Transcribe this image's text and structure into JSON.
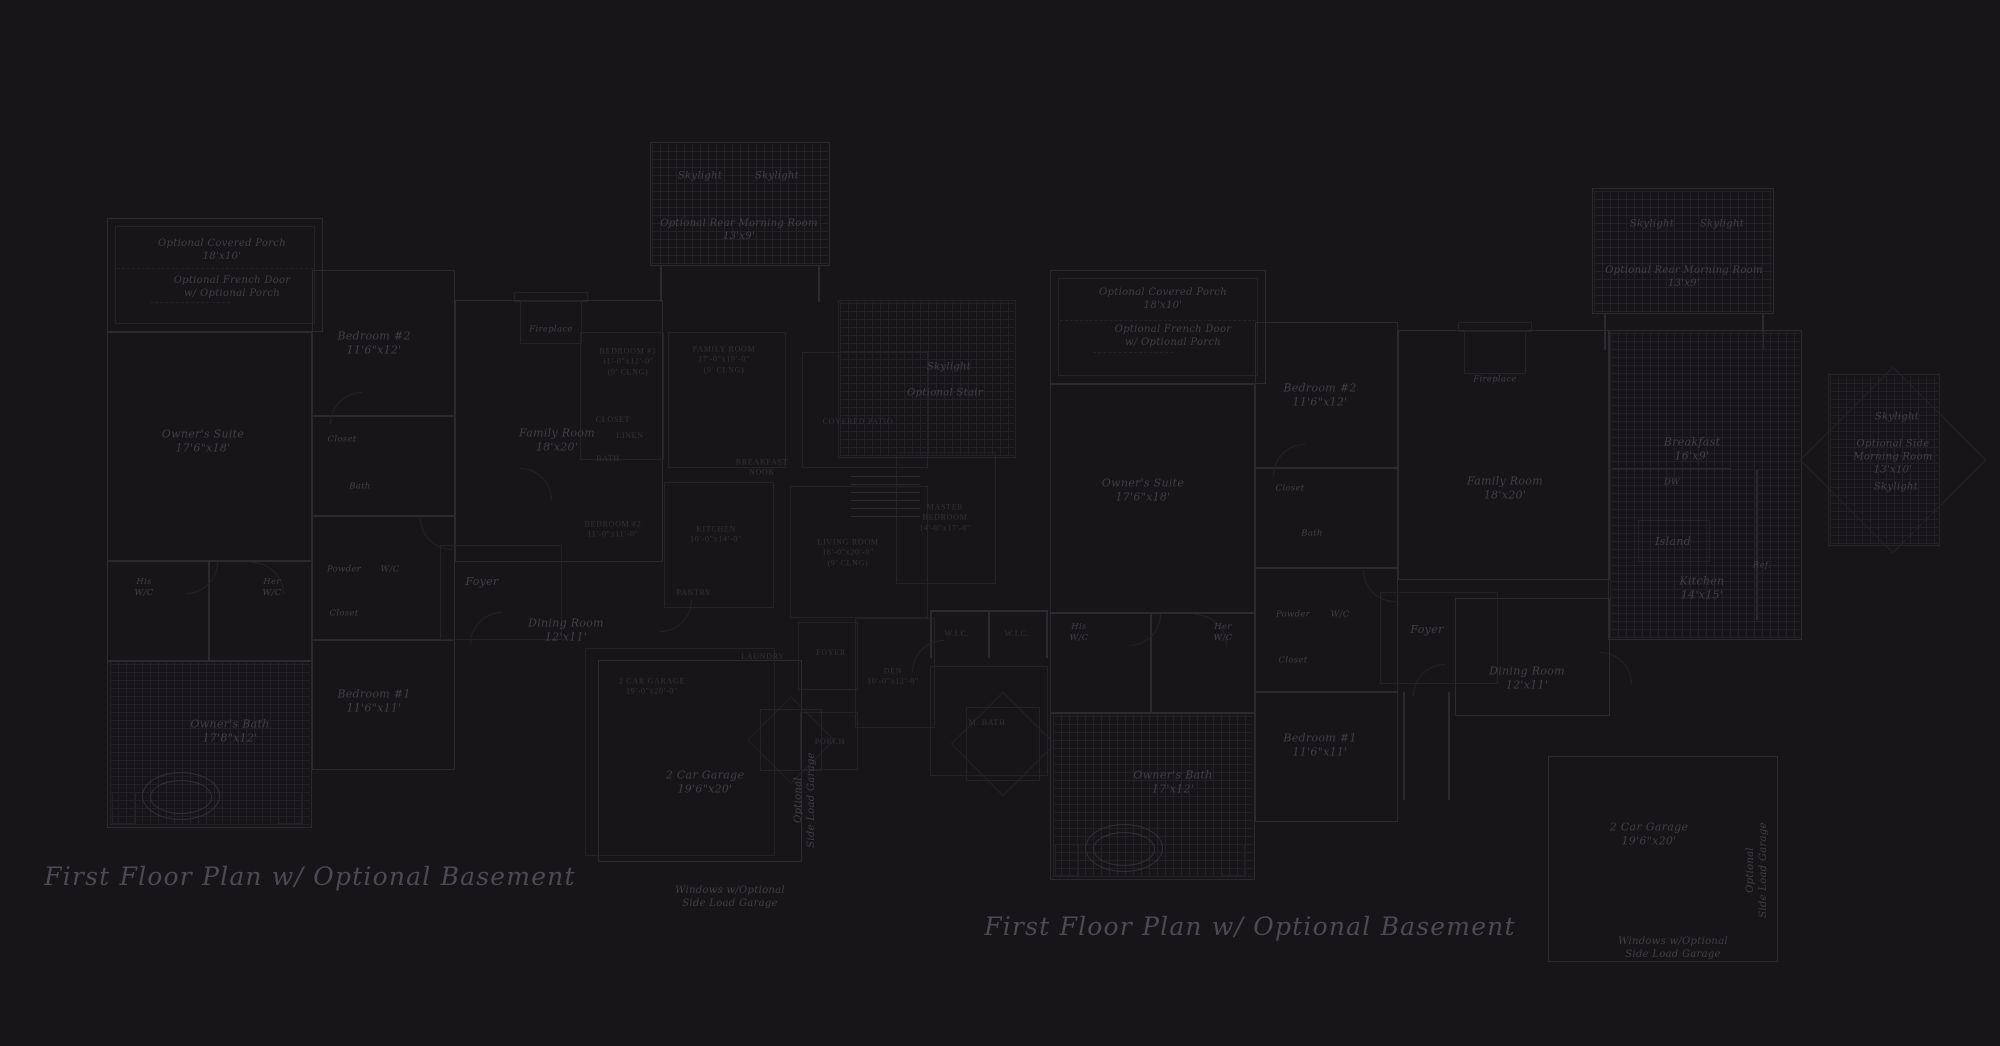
{
  "meta": {
    "description": "Two dark blueprint-style first floor plans shown side by side with a fainter overlapping plan in the center",
    "colors": {
      "background": "#171518",
      "wall_line": "#2c2a2e",
      "wall_line_faint": "#242226",
      "fixture_line": "#333136",
      "grid_line": "#232126",
      "label_text": "#413f46",
      "overlay_caps_text": "#343238",
      "title_text": "#4c4a53"
    }
  },
  "titles": {
    "left": "First Floor Plan  w/ Optional Basement",
    "right": "First Floor Plan  w/ Optional Basement"
  },
  "labels": [
    {
      "t": "Optional Covered Porch\n18'x10'",
      "x": 222,
      "y": 250,
      "c": "small"
    },
    {
      "t": "Optional French Door\nw/ Optional Porch",
      "x": 232,
      "y": 287,
      "c": "small"
    },
    {
      "t": "Bedroom #2\n11'6\"x12'",
      "x": 374,
      "y": 344,
      "c": "room"
    },
    {
      "t": "Closet",
      "x": 342,
      "y": 440,
      "c": "tiny"
    },
    {
      "t": "Bath",
      "x": 360,
      "y": 487,
      "c": "tiny"
    },
    {
      "t": "Owner's Suite\n17'6\"x18'",
      "x": 203,
      "y": 442,
      "c": "room"
    },
    {
      "t": "Family Room\n18'x20'",
      "x": 557,
      "y": 441,
      "c": "room"
    },
    {
      "t": "Fireplace",
      "x": 551,
      "y": 330,
      "c": "tiny"
    },
    {
      "t": "Skylight",
      "x": 700,
      "y": 176,
      "c": "small"
    },
    {
      "t": "Skylight",
      "x": 777,
      "y": 176,
      "c": "small"
    },
    {
      "t": "Optional Rear Morning Room\n13'x9'",
      "x": 739,
      "y": 230,
      "c": "small"
    },
    {
      "t": "Skylight",
      "x": 949,
      "y": 367,
      "c": "small"
    },
    {
      "t": "Optional Stair",
      "x": 945,
      "y": 393,
      "c": "small"
    },
    {
      "t": "His\nW/C",
      "x": 144,
      "y": 588,
      "c": "tiny"
    },
    {
      "t": "Her\nW/C",
      "x": 272,
      "y": 588,
      "c": "tiny"
    },
    {
      "t": "Powder",
      "x": 344,
      "y": 570,
      "c": "tiny"
    },
    {
      "t": "W/C",
      "x": 390,
      "y": 570,
      "c": "tiny"
    },
    {
      "t": "Closet",
      "x": 344,
      "y": 614,
      "c": "tiny"
    },
    {
      "t": "Foyer",
      "x": 482,
      "y": 582,
      "c": "room"
    },
    {
      "t": "Dining Room\n12'x11'",
      "x": 566,
      "y": 631,
      "c": "room"
    },
    {
      "t": "Bedroom #1\n11'6\"x11'",
      "x": 374,
      "y": 702,
      "c": "room"
    },
    {
      "t": "Owner's Bath\n17'8\"x12'",
      "x": 230,
      "y": 732,
      "c": "room"
    },
    {
      "t": "2 Car Garage\n19'6\"x20'",
      "x": 705,
      "y": 783,
      "c": "room"
    },
    {
      "t": "Optional\nSide Load Garage",
      "x": 805,
      "y": 800,
      "c": "small",
      "r": -90
    },
    {
      "t": "Windows w/Optional\nSide Load Garage",
      "x": 730,
      "y": 897,
      "c": "small"
    },
    {
      "t": "First Floor Plan  w/ Optional Basement",
      "x": 310,
      "y": 877,
      "c": "title",
      "n": "plan-title-left"
    },
    {
      "t": "BEDROOM #3\n11'-0\"x12'-0\"\n(9' CLNG)",
      "x": 628,
      "y": 362,
      "c": "caps"
    },
    {
      "t": "FAMILY ROOM\n17'-0\"x19'-0\"\n(9' CLNG)",
      "x": 724,
      "y": 360,
      "c": "caps"
    },
    {
      "t": "CLOSET",
      "x": 613,
      "y": 420,
      "c": "caps"
    },
    {
      "t": "LINEN",
      "x": 630,
      "y": 436,
      "c": "caps"
    },
    {
      "t": "BATH",
      "x": 608,
      "y": 459,
      "c": "caps"
    },
    {
      "t": "COVERED PATIO",
      "x": 858,
      "y": 422,
      "c": "caps"
    },
    {
      "t": "BREAKFAST\nNOOK",
      "x": 762,
      "y": 468,
      "c": "caps"
    },
    {
      "t": "BEDROOM #2\n11'-0\"x11'-0\"",
      "x": 613,
      "y": 530,
      "c": "caps"
    },
    {
      "t": "KITCHEN\n10'-0\"x14'-0\"",
      "x": 716,
      "y": 535,
      "c": "caps"
    },
    {
      "t": "LIVING ROOM\n16'-0\"x20'-0\"\n(9' CLNG)",
      "x": 848,
      "y": 553,
      "c": "caps"
    },
    {
      "t": "MASTER\nBEDROOM\n14'-0\"x17'-0\"",
      "x": 945,
      "y": 518,
      "c": "caps"
    },
    {
      "t": "PANTRY",
      "x": 694,
      "y": 593,
      "c": "caps"
    },
    {
      "t": "LAUNDRY",
      "x": 763,
      "y": 657,
      "c": "caps"
    },
    {
      "t": "W.I.C.",
      "x": 957,
      "y": 634,
      "c": "caps"
    },
    {
      "t": "W.I.C.",
      "x": 1017,
      "y": 634,
      "c": "caps"
    },
    {
      "t": "FOYER",
      "x": 831,
      "y": 653,
      "c": "caps"
    },
    {
      "t": "DEN\n10'-0\"x12'-0\"",
      "x": 893,
      "y": 677,
      "c": "caps"
    },
    {
      "t": "M. BATH",
      "x": 987,
      "y": 723,
      "c": "caps"
    },
    {
      "t": "PORCH",
      "x": 830,
      "y": 742,
      "c": "caps"
    },
    {
      "t": "2 CAR GARAGE\n19'-0\"x20'-0\"",
      "x": 652,
      "y": 687,
      "c": "caps"
    },
    {
      "t": "Optional Covered Porch\n18'x10'",
      "x": 1163,
      "y": 299,
      "c": "small"
    },
    {
      "t": "Optional French Door\nw/ Optional Porch",
      "x": 1173,
      "y": 336,
      "c": "small"
    },
    {
      "t": "Bedroom #2\n11'6\"x12'",
      "x": 1320,
      "y": 396,
      "c": "room"
    },
    {
      "t": "Closet",
      "x": 1290,
      "y": 489,
      "c": "tiny"
    },
    {
      "t": "Bath",
      "x": 1312,
      "y": 534,
      "c": "tiny"
    },
    {
      "t": "Owner's Suite\n17'6\"x18'",
      "x": 1143,
      "y": 491,
      "c": "room"
    },
    {
      "t": "Family Room\n18'x20'",
      "x": 1505,
      "y": 489,
      "c": "room"
    },
    {
      "t": "Fireplace",
      "x": 1495,
      "y": 380,
      "c": "tiny"
    },
    {
      "t": "Skylight",
      "x": 1652,
      "y": 224,
      "c": "small"
    },
    {
      "t": "Skylight",
      "x": 1722,
      "y": 224,
      "c": "small"
    },
    {
      "t": "Optional Rear Morning Room\n13'x9'",
      "x": 1684,
      "y": 277,
      "c": "small"
    },
    {
      "t": "Breakfast\n16'x9'",
      "x": 1692,
      "y": 450,
      "c": "room"
    },
    {
      "t": "DW",
      "x": 1672,
      "y": 483,
      "c": "tiny"
    },
    {
      "t": "Island",
      "x": 1673,
      "y": 542,
      "c": "room"
    },
    {
      "t": "Kitchen\n14'x15'",
      "x": 1702,
      "y": 589,
      "c": "room"
    },
    {
      "t": "Ref.",
      "x": 1762,
      "y": 566,
      "c": "tiny"
    },
    {
      "t": "Skylight",
      "x": 1897,
      "y": 417,
      "c": "small"
    },
    {
      "t": "Optional Side\nMorning Room\n13'x10'",
      "x": 1893,
      "y": 457,
      "c": "small"
    },
    {
      "t": "Skylight",
      "x": 1896,
      "y": 487,
      "c": "small"
    },
    {
      "t": "His\nW/C",
      "x": 1079,
      "y": 633,
      "c": "tiny"
    },
    {
      "t": "Her\nW/C",
      "x": 1223,
      "y": 633,
      "c": "tiny"
    },
    {
      "t": "Powder",
      "x": 1293,
      "y": 615,
      "c": "tiny"
    },
    {
      "t": "W/C",
      "x": 1340,
      "y": 615,
      "c": "tiny"
    },
    {
      "t": "Closet",
      "x": 1293,
      "y": 661,
      "c": "tiny"
    },
    {
      "t": "Foyer",
      "x": 1427,
      "y": 630,
      "c": "room"
    },
    {
      "t": "Dining Room\n12'x11'",
      "x": 1527,
      "y": 679,
      "c": "room"
    },
    {
      "t": "Bedroom #1\n11'6\"x11'",
      "x": 1320,
      "y": 746,
      "c": "room"
    },
    {
      "t": "Owner's Bath\n17'x12'",
      "x": 1173,
      "y": 783,
      "c": "room"
    },
    {
      "t": "2 Car Garage\n19'6\"x20'",
      "x": 1649,
      "y": 835,
      "c": "room"
    },
    {
      "t": "Optional\nSide Load Garage",
      "x": 1757,
      "y": 870,
      "c": "small",
      "r": -90
    },
    {
      "t": "Windows w/Optional\nSide Load Garage",
      "x": 1673,
      "y": 948,
      "c": "small"
    },
    {
      "t": "First Floor Plan  w/ Optional Basement",
      "x": 1250,
      "y": 927,
      "c": "title",
      "n": "plan-title-right"
    }
  ]
}
